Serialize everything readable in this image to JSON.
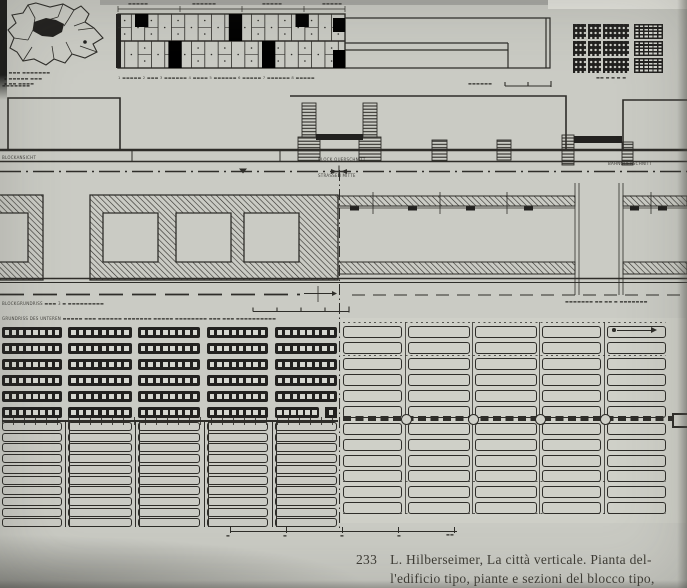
{
  "figure": {
    "caption": {
      "number": "233",
      "line1": "L. Hilberseimer, La città verticale. Pianta del-",
      "line2": "l'edificio tipo, piante e sezioni del blocco tipo,"
    }
  },
  "labels": {
    "map_legend": [
      "▪ ▬▬▬ ▬▬▬▬▬▬▬",
      "▪ ▬▬▬▬▬ ▬▬▬",
      "▪ ▬▬ ▬▬▬▬"
    ],
    "strip_dims": [
      "▬▬▬▬▬",
      "▬▬▬▬▬▬",
      "▬▬▬▬▬",
      "▬▬▬▬▬"
    ],
    "strip_legend": "1 ▬▬▬▬▬ 2 ▬▬▬ 3 ▬▬▬▬▬▬ 4 ▬▬▬▬ 5 ▬▬▬▬▬▬ 6 ▬▬▬▬▬ 7 ▬▬▬▬▬▬ 8 ▬▬▬▬▬",
    "strip_scale": "▬▬▬▬▬▬",
    "grid_scale": "▬▬ ▬ ▬ ▬ ▬",
    "band_b_top_left": "▬▬▬▬▬▬▬",
    "view_left": "BLOCKANSICHT",
    "block_section": "BLOCK QUERSCHNITT",
    "street_center": "STRASSEN MITTE",
    "rail_right": "BAHNQUERSCHNITT",
    "plan_label_left": "BLOCKGRUNDRISS ▬▬▬ 3 ▬ ▬▬▬▬▬▬▬▬▬",
    "plan_label_right": "▬▬▬▬▬▬▬ ▬▬ ▬▬ ▬ ▬▬▬▬▬▬▬",
    "plan_lower_note": "GRUNDRISS DES UNTEREN ▬▬▬▬▬ ▬▬▬ ▬▬▬▬▬▬ ▬▬▬▬▬▬▬ ▬▬▬▬▬ ▬▬▬▬▬▬▬▬ ▬▬▬ ▬▬▬ ▬▬▬▬▬▬▬▬▬▬",
    "bottom_scale": [
      "▬",
      "▬",
      "▬",
      "▬",
      "▬▬"
    ]
  },
  "colors": {
    "plate_bg": "#cacbc4",
    "plan_right_bg": "#cfd0c8",
    "ink": "#2e2d29",
    "dark_fill": "#22211f",
    "window_fill": "#d6d7d0",
    "caption_ink": "#3e3c35"
  },
  "drawing": {
    "site_block_grid": {
      "rows": 3,
      "cols": 4
    },
    "window_bar_grid": {
      "cols": 5,
      "rows": 6,
      "windows_per_bar": 8
    },
    "left_lower_slab_grid": {
      "cols": 5,
      "rows": 10
    },
    "right_upper_slab_grid": {
      "cols": 5,
      "rows": 6
    },
    "right_lower_slab_grid": {
      "cols": 5,
      "rows": 6
    },
    "courtyards_main_block": 3,
    "section_towers": 2
  }
}
